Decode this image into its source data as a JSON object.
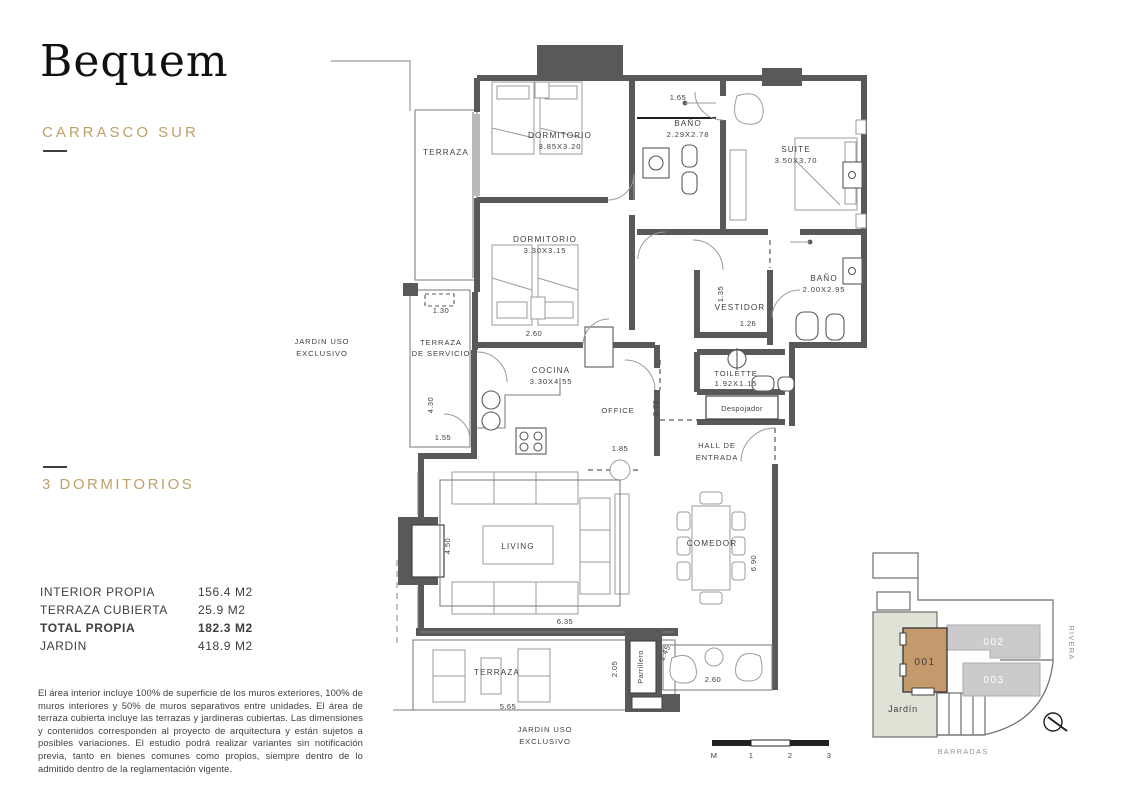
{
  "brand": {
    "logo": "Bequem",
    "location": "CARRASCO SUR"
  },
  "unit": {
    "type_label": "3 DORMITORIOS"
  },
  "areas": {
    "rows": [
      {
        "label": "INTERIOR PROPIA",
        "value": "156.4 M2"
      },
      {
        "label": "TERRAZA CUBIERTA",
        "value": "25.9 M2"
      },
      {
        "label": "TOTAL PROPIA",
        "value": "182.3 M2"
      },
      {
        "label": "JARDIN",
        "value": "418.9 M2"
      }
    ]
  },
  "disclaimer": "El área interior incluye 100% de superficie de los muros exteriores, 100% de muros interiores y 50% de muros separativos entre unidades. El área  de terraza cubierta incluye las terrazas y jardineras cubiertas. Las dimensiones y contenidos corresponden al proyecto de arquitectura y están sujetos a posibles variaciones. El estudio podrá realizar variantes sin notificación previa, tanto en bienes comunes como propios, siempre dentro de lo admitido dentro de la reglamentación vigente.",
  "floorplan": {
    "rooms": {
      "terraza_n": "TERRAZA",
      "dorm1": "DORMITORIO",
      "dorm1_dim": "3.85X3.20",
      "bano1": "BAÑO",
      "bano1_dim": "2.29X2.78",
      "suite": "SUITE",
      "suite_dim": "3.50X3.70",
      "dorm2": "DORMITORIO",
      "dorm2_dim": "3.30X3.15",
      "vestidor": "VESTIDOR",
      "bano2": "BAÑO",
      "bano2_dim": "2.00X2.95",
      "terraza_serv1": "TERRAZA",
      "terraza_serv2": "DE SERVICIO",
      "cocina": "COCINA",
      "cocina_dim": "3.30X4.55",
      "office": "OFFICE",
      "toilette": "TOILETTE",
      "toilette_dim": "1.92X1.15",
      "despojador": "Despojador",
      "hall1": "HALL DE",
      "hall2": "ENTRADA",
      "living": "LIVING",
      "comedor": "COMEDOR",
      "terraza_s": "TERRAZA",
      "parrillero": "Parrillero",
      "jardin1": "JARDIN USO",
      "jardin2": "EXCLUSIVO"
    },
    "dims": {
      "a165": "1.65",
      "a130": "1.30",
      "a260": "2.60",
      "a430": "4.30",
      "a155": "1.55",
      "a135": "1.35",
      "a126": "1.26",
      "a273": "2.73",
      "a185": "1.85",
      "a450": "4.50",
      "a635": "6.35",
      "a690": "6.90",
      "a205": "2.05",
      "a565": "5.65",
      "a145": "1.45",
      "b260": "2.60"
    },
    "scalebar": {
      "m": "M",
      "one": "1",
      "two": "2",
      "three": "3"
    }
  },
  "keyplan": {
    "unit1": "001",
    "unit2": "002",
    "unit3": "003",
    "jardin": "Jardín",
    "street_right": "RIVERA",
    "street_bottom": "BARRADAS"
  },
  "colors": {
    "accent_gold": "#BFA06A",
    "wall": "#58595B",
    "unit_highlight": "#C49A6C",
    "unit_other": "#CBCBCD",
    "jardin_green": "#DFE3D6"
  }
}
